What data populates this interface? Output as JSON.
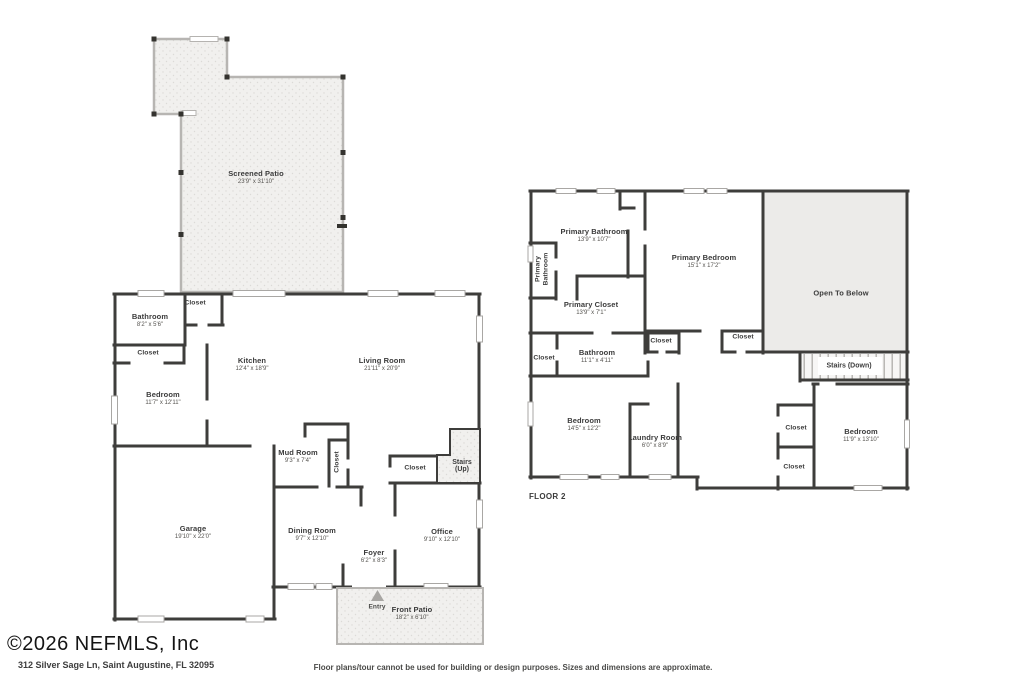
{
  "footer": {
    "copyright": "©2026 NEFMLS, Inc",
    "address": "312 Silver Sage Ln, Saint Augustine, FL 32095",
    "disclaimer": "Floor plans/tour cannot be used for building or design purposes. Sizes and dimensions are approximate."
  },
  "floor1": {
    "rooms": {
      "screened_patio": {
        "name": "Screened Patio",
        "dims": "23'9\" x 31'10\""
      },
      "bathroom": {
        "name": "Bathroom",
        "dims": "8'2\" x 5'6\""
      },
      "closet_top": {
        "name": "Closet"
      },
      "closet_left": {
        "name": "Closet"
      },
      "bedroom": {
        "name": "Bedroom",
        "dims": "11'7\" x 12'11\""
      },
      "kitchen": {
        "name": "Kitchen",
        "dims": "12'4\" x 18'9\""
      },
      "living_room": {
        "name": "Living Room",
        "dims": "21'11\" x 20'9\""
      },
      "mud_room": {
        "name": "Mud Room",
        "dims": "9'3\" x 7'4\""
      },
      "closet_mud": {
        "name": "Closet"
      },
      "closet_hall": {
        "name": "Closet"
      },
      "stairs_up": {
        "name": "Stairs",
        "sub": "(Up)"
      },
      "garage": {
        "name": "Garage",
        "dims": "19'10\" x 22'0\""
      },
      "dining_room": {
        "name": "Dining Room",
        "dims": "9'7\" x 12'10\""
      },
      "foyer": {
        "name": "Foyer",
        "dims": "6'2\" x 8'3\""
      },
      "office": {
        "name": "Office",
        "dims": "9'10\" x 12'10\""
      },
      "entry": {
        "name": "Entry"
      },
      "front_patio": {
        "name": "Front Patio",
        "dims": "18'2\" x 6'10\""
      }
    }
  },
  "floor2": {
    "label": "FLOOR 2",
    "rooms": {
      "primary_bathroom": {
        "name": "Primary Bathroom",
        "dims": "13'9\" x 10'7\""
      },
      "primary_bathroom_side": {
        "name": "Primary Bathroom"
      },
      "primary_closet": {
        "name": "Primary Closet",
        "dims": "13'9\" x 7'1\""
      },
      "primary_bedroom": {
        "name": "Primary Bedroom",
        "dims": "15'1\" x 17'2\""
      },
      "open_to_below": {
        "name": "Open To Below"
      },
      "stairs_down": {
        "name": "Stairs (Down)"
      },
      "closet_mid_left": {
        "name": "Closet"
      },
      "closet_mid_right": {
        "name": "Closet"
      },
      "closet_left_edge": {
        "name": "Closet"
      },
      "bathroom": {
        "name": "Bathroom",
        "dims": "11'1\" x 4'11\""
      },
      "bedroom_left": {
        "name": "Bedroom",
        "dims": "14'5\" x 12'2\""
      },
      "laundry_room": {
        "name": "Laundry Room",
        "dims": "6'0\" x 8'9\""
      },
      "closet_right_upper": {
        "name": "Closet"
      },
      "closet_right_lower": {
        "name": "Closet"
      },
      "bedroom_right": {
        "name": "Bedroom",
        "dims": "11'9\" x 13'10\""
      }
    }
  },
  "colors": {
    "wall": "#3e3d3b",
    "patio_fill": "#f1f0ee",
    "open_to_below_fill": "#ecebe9",
    "text": "#3b3b3b"
  }
}
